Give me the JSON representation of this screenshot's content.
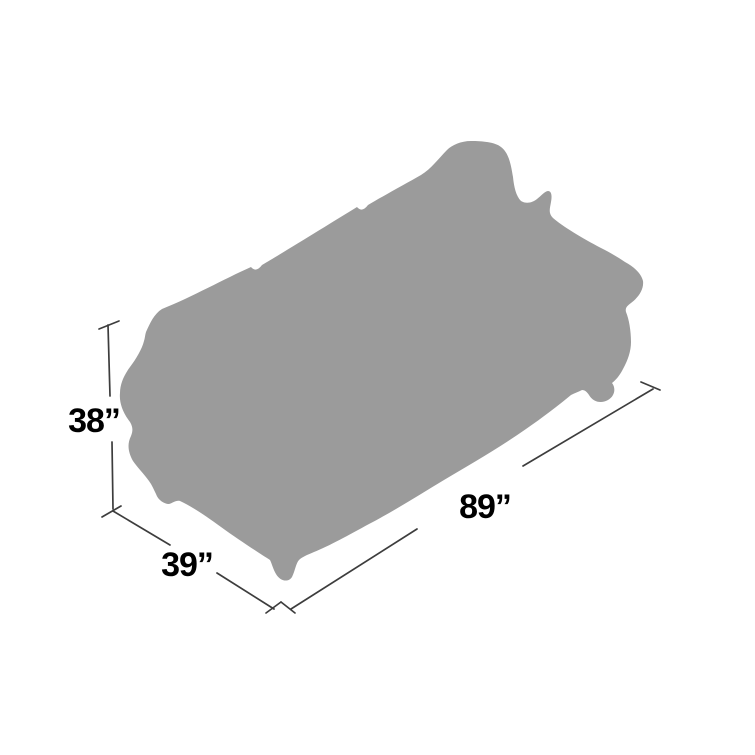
{
  "diagram": {
    "type": "product-dimensions",
    "subject": "sofa-silhouette",
    "colors": {
      "background": "#FFFFFF",
      "silhouette": "#9B9B9B",
      "line": "#3D3D3D",
      "label": "#000000"
    },
    "labels": {
      "height": "38”",
      "depth": "39”",
      "width": "89”"
    }
  }
}
